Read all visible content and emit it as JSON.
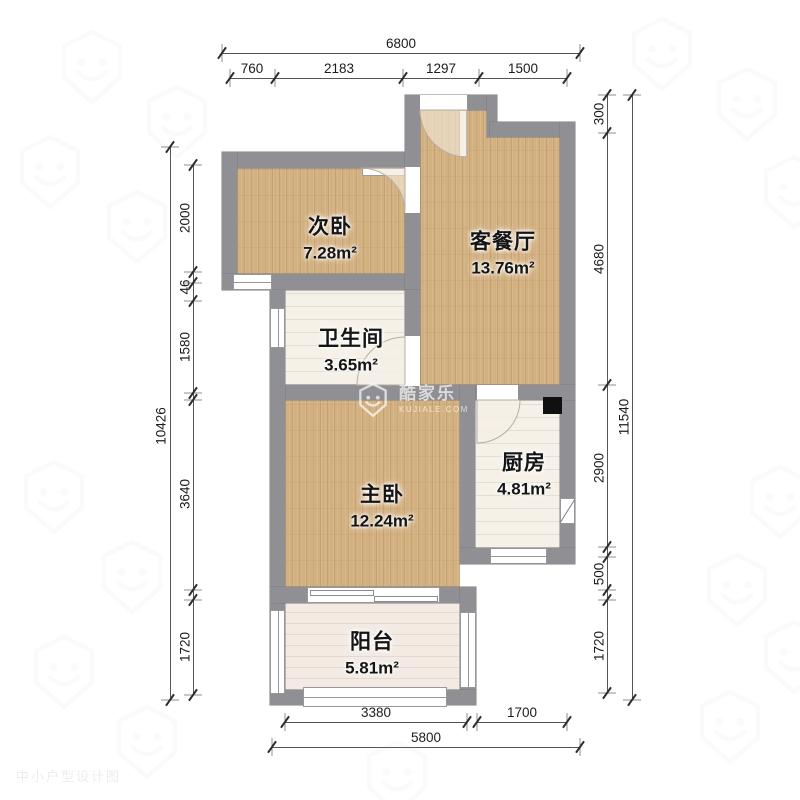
{
  "rooms": [
    {
      "name": "次卧",
      "area": "7.28m²"
    },
    {
      "name": "客餐厅",
      "area": "13.76m²"
    },
    {
      "name": "卫生间",
      "area": "3.65m²"
    },
    {
      "name": "主卧",
      "area": "12.24m²"
    },
    {
      "name": "厨房",
      "area": "4.81m²"
    },
    {
      "name": "阳台",
      "area": "5.81m²"
    }
  ],
  "dims": {
    "top": {
      "overall": "6800",
      "segments": [
        "760",
        "2183",
        "1297",
        "1500"
      ]
    },
    "bottom": {
      "overall": "5800",
      "segments": [
        "3380",
        "1700"
      ]
    },
    "left": {
      "overall": "10426",
      "segments": [
        "2000",
        "46",
        "1580",
        "3640",
        "1720"
      ]
    },
    "right": {
      "overall": "11540",
      "segments": [
        "300",
        "4680",
        "2900",
        "500",
        "1720"
      ]
    }
  },
  "watermark": {
    "brand": "酷家乐",
    "domain": "KUJIALE.COM",
    "corner_text": "中小户型设计图"
  },
  "colors": {
    "wall": "#909094",
    "wood_floor": "#d3b080",
    "tile_floor": "#f6f1e8",
    "balcony_floor": "#f2eae3",
    "flue": "#101010"
  }
}
